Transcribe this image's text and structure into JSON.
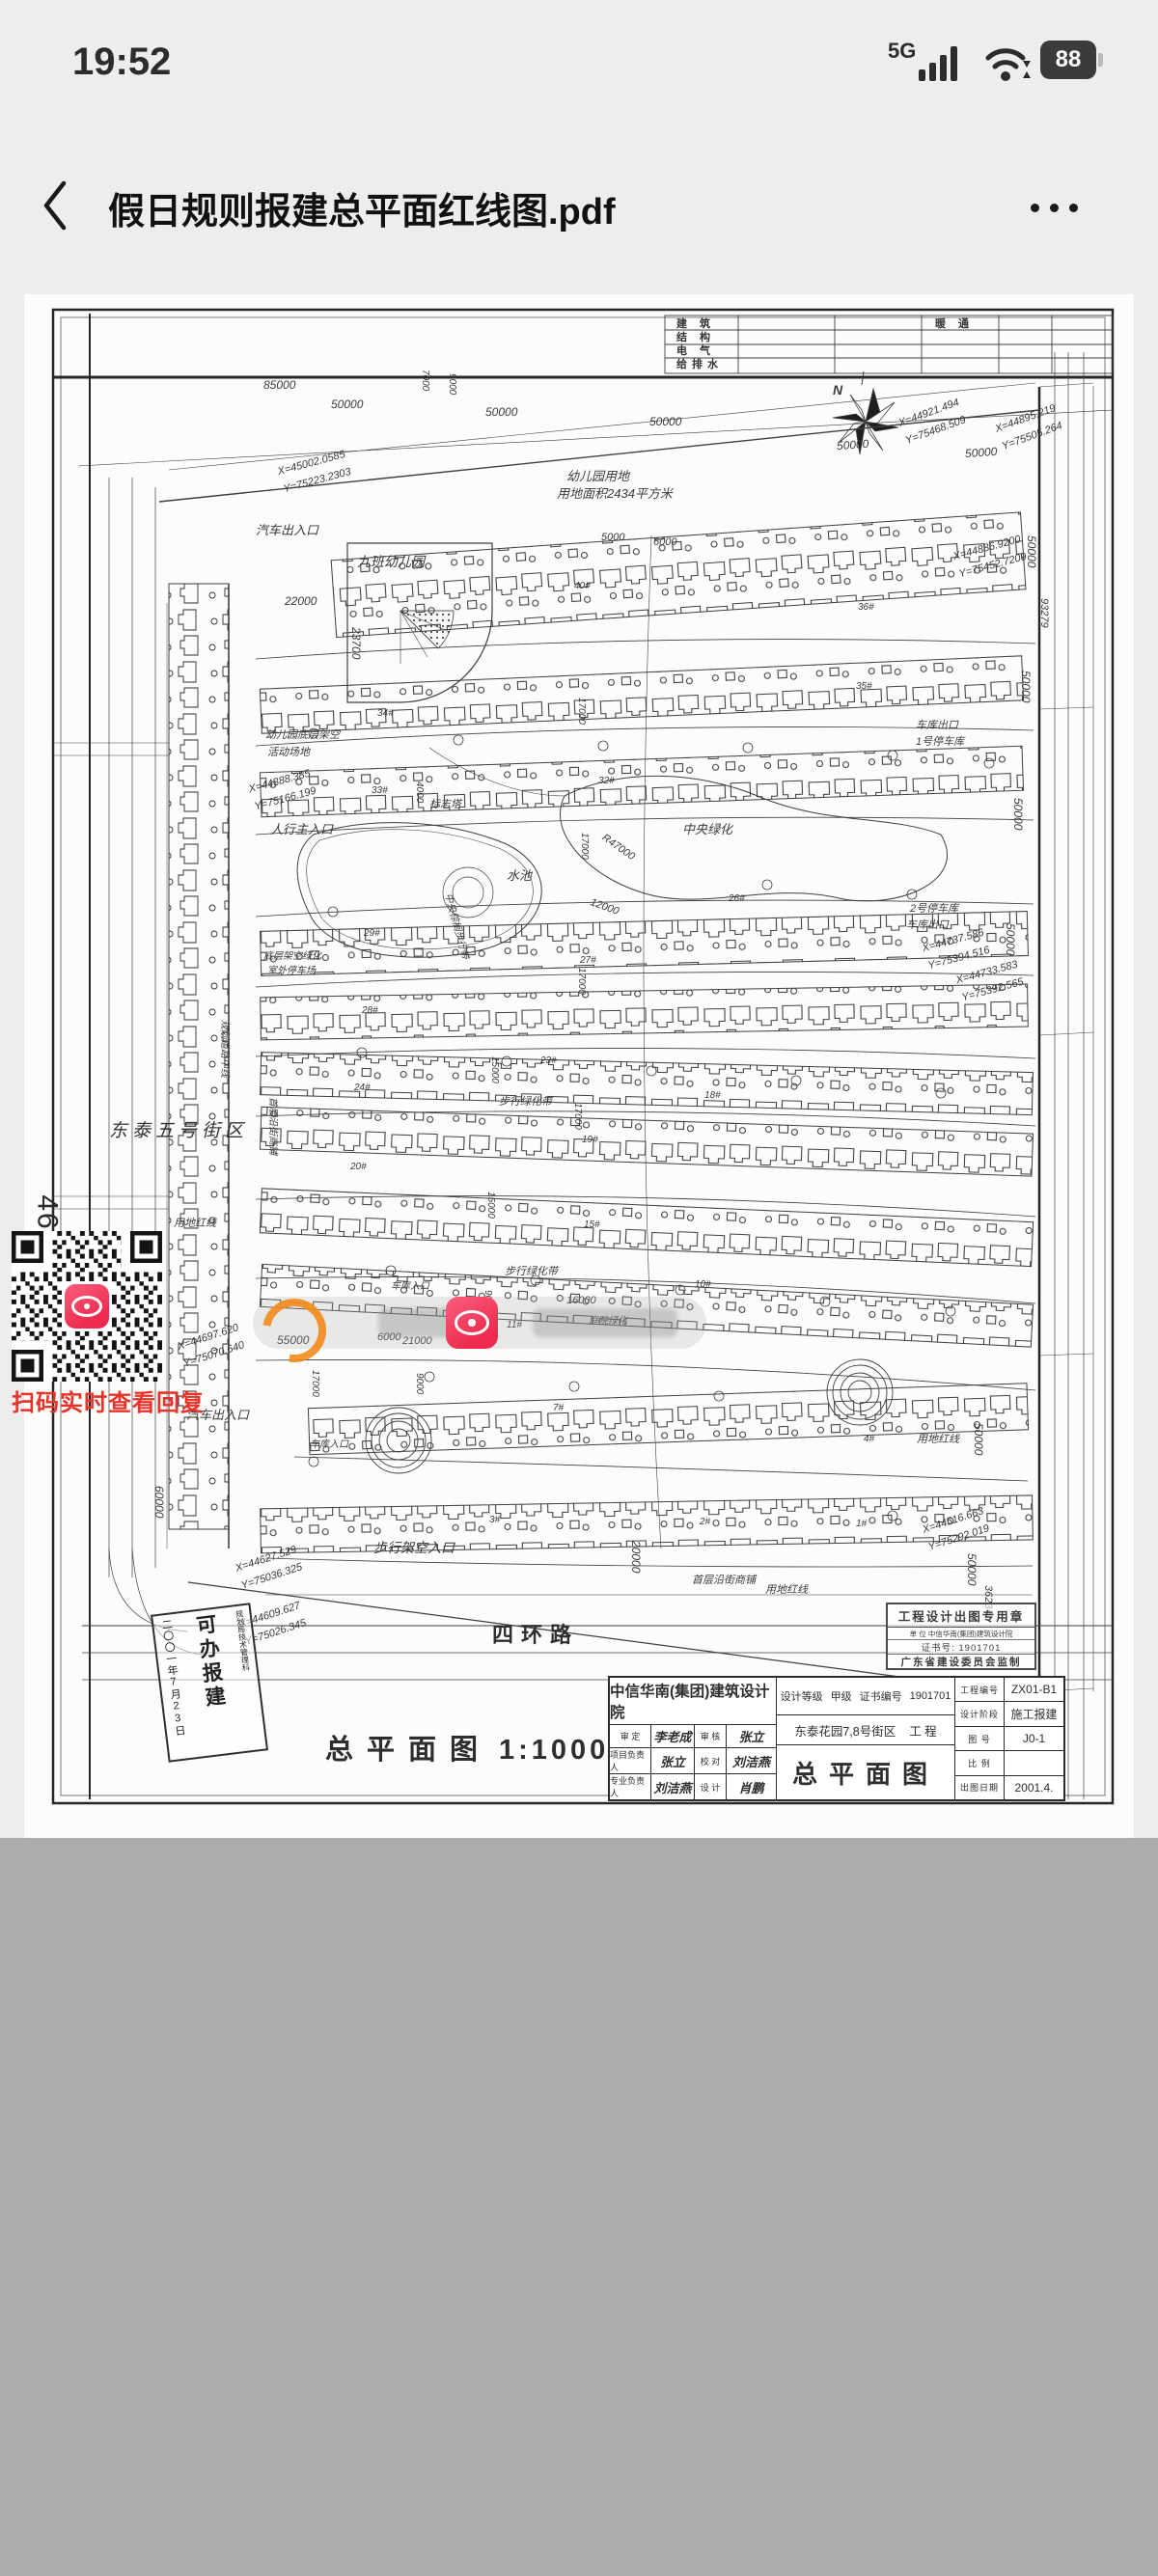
{
  "status_bar": {
    "time": "19:52",
    "network": "5G",
    "battery_percent": "88"
  },
  "header": {
    "title": "假日规则报建总平面红线图.pdf"
  },
  "page_margin": {
    "page_number": "46"
  },
  "qr_block": {
    "caption": "扫码实时查看回复"
  },
  "drawing": {
    "corner_table": {
      "rows": [
        "建 筑",
        "结 构",
        "电 气",
        "给排水"
      ],
      "hvac": "暖 通"
    },
    "north": "N",
    "road": "四环路",
    "scale_caption": {
      "title": "总平面图",
      "scale": "1:1000"
    },
    "approval_stamp": {
      "date": "二〇〇一年7月23日",
      "main": "可办报建",
      "agency": "规划局技术管理科"
    },
    "seal": {
      "title": "工程设计出图专用章",
      "unit": "单 位  中信华南(集团)建筑设计院",
      "cert": "证书号: 1901701",
      "issuer": "广东省建设委员会监制"
    },
    "title_block": {
      "firm": "中信华南(集团)建筑设计院",
      "grade_label": "设计等级",
      "grade": "甲级",
      "cert_label": "证书编号",
      "cert": "1901701",
      "r1l": "审 定",
      "r1v": "李老成",
      "r1l2": "审 核",
      "r1v2": "张立",
      "r2l": "项目负责人",
      "r2v": "张立",
      "r2l2": "校 对",
      "r2v2": "刘洁燕",
      "r3l": "专业负责人",
      "r3v": "刘洁燕",
      "r3l2": "设 计",
      "r3v2": "肖鹏",
      "project": "东泰花园7,8号街区",
      "project_suffix": "工 程",
      "sheet_title": "总平面图",
      "c1l": "工程编号",
      "c1v": "ZX01-B1",
      "c2l": "设计阶段",
      "c2v": "施工报建",
      "c3l": "图 号",
      "c3v": "J0-1",
      "c4l": "比 例",
      "c4v": "",
      "c5l": "出图日期",
      "c5v": "2001.4."
    },
    "labels": [
      "85000",
      "50000",
      "50000",
      "50000",
      "50000",
      "50000",
      "X=44921.494",
      "Y=75468.509",
      "X=44895.219",
      "Y=75505.264",
      "X=45002.0585",
      "Y=75223.2303",
      "幼儿园用地",
      "用地面积2434平方米",
      "汽车出入口",
      "九班幼儿园",
      "22000",
      "23700",
      "7000",
      "9000",
      "5000",
      "6000",
      "幼儿园底层架空",
      "活动场地",
      "X=44888.385",
      "Y=75166.199",
      "人行主入口",
      "东泰五号街区",
      "规划道路中线",
      "首层沿街商铺",
      "底层架空绿化",
      "室外停车场",
      "标志塔",
      "4000",
      "水池",
      "中央绿化",
      "R47000",
      "12000",
      "中央棕榈步行带",
      "17000",
      "17000",
      "17000",
      "17000",
      "15000",
      "15000",
      "9000",
      "步行绿化带",
      "步行绿化带",
      "庭院绿化",
      "16000",
      "车库出口",
      "1号停车库",
      "2号停车库",
      "车库出口",
      "X=44737.586",
      "Y=75394.516",
      "X=44733.583",
      "Y=75392.565",
      "X=44886.9200",
      "Y=75452.7209",
      "93279",
      "50000",
      "50000",
      "50000",
      "50000",
      "50000",
      "50000",
      "36234",
      "X=44516.663",
      "Y=75292.019",
      "用地红线",
      "用地红线",
      "用地红线",
      "60000",
      "55000",
      "17000",
      "汽车出入口",
      "车库入口",
      "21000",
      "9000",
      "6000",
      "车库入口",
      "步行架空入口",
      "X=44697.620",
      "Y=75070.640",
      "X=44627.529",
      "Y=75036.325",
      "X=44609.627",
      "Y=75026.345",
      "20000",
      "首层沿街商铺",
      "2#",
      "1#",
      "3#",
      "4#",
      "7#",
      "10#",
      "11#",
      "15#",
      "18#",
      "19#",
      "20#",
      "23#",
      "24#",
      "26#",
      "27#",
      "28#",
      "29#",
      "32#",
      "33#",
      "34#",
      "35#",
      "36#",
      "40#"
    ]
  }
}
